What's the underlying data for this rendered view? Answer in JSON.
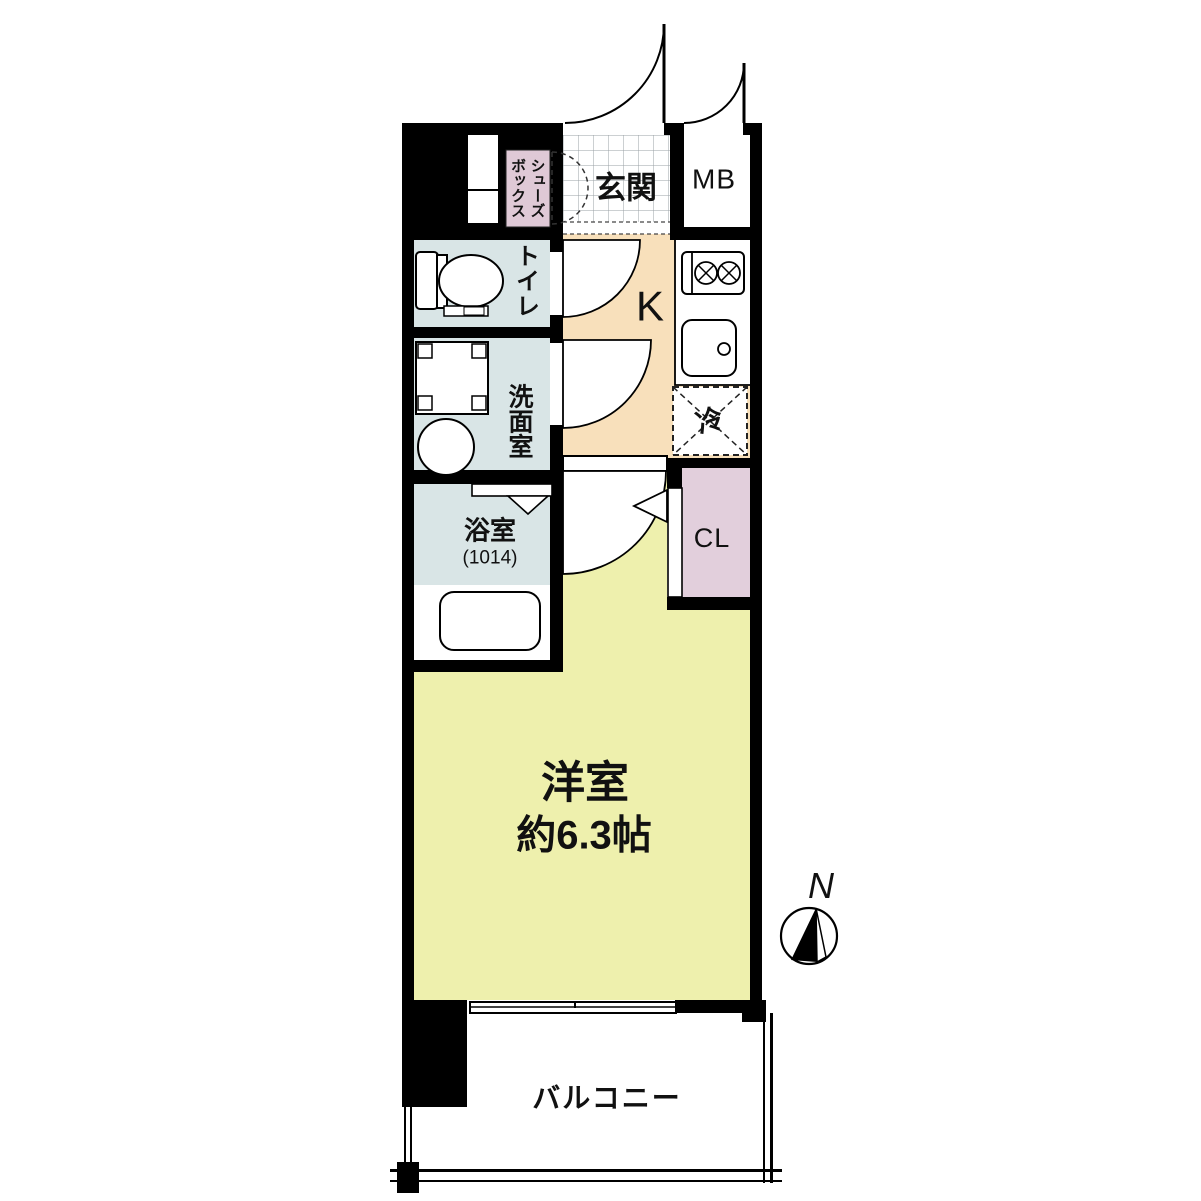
{
  "floor_plan": {
    "rooms": {
      "entrance": {
        "label": "玄関"
      },
      "meter_box": {
        "label": "MB"
      },
      "shoe_box": {
        "label": "シューズ\nボックス"
      },
      "toilet": {
        "label": "トイレ"
      },
      "washroom": {
        "label": "洗面室"
      },
      "bathroom": {
        "label": "浴室",
        "size": "(1014)"
      },
      "kitchen": {
        "label": "K"
      },
      "refrigerator_space": {
        "label": "冷"
      },
      "closet": {
        "label": "CL"
      },
      "main_room": {
        "label": "洋室",
        "size": "約6.3帖"
      },
      "balcony": {
        "label": "バルコニー"
      }
    },
    "compass": {
      "north": "N"
    },
    "colors": {
      "wall": "#000000",
      "water_room_fill": "#d9e5e6",
      "kitchen_fill": "#f8e0bb",
      "main_room_fill": "#eef0ad",
      "closet_fill": "#e2cfdc",
      "shoe_box_fill": "#dfc9d6",
      "tile_line": "#9aa0a6"
    }
  }
}
